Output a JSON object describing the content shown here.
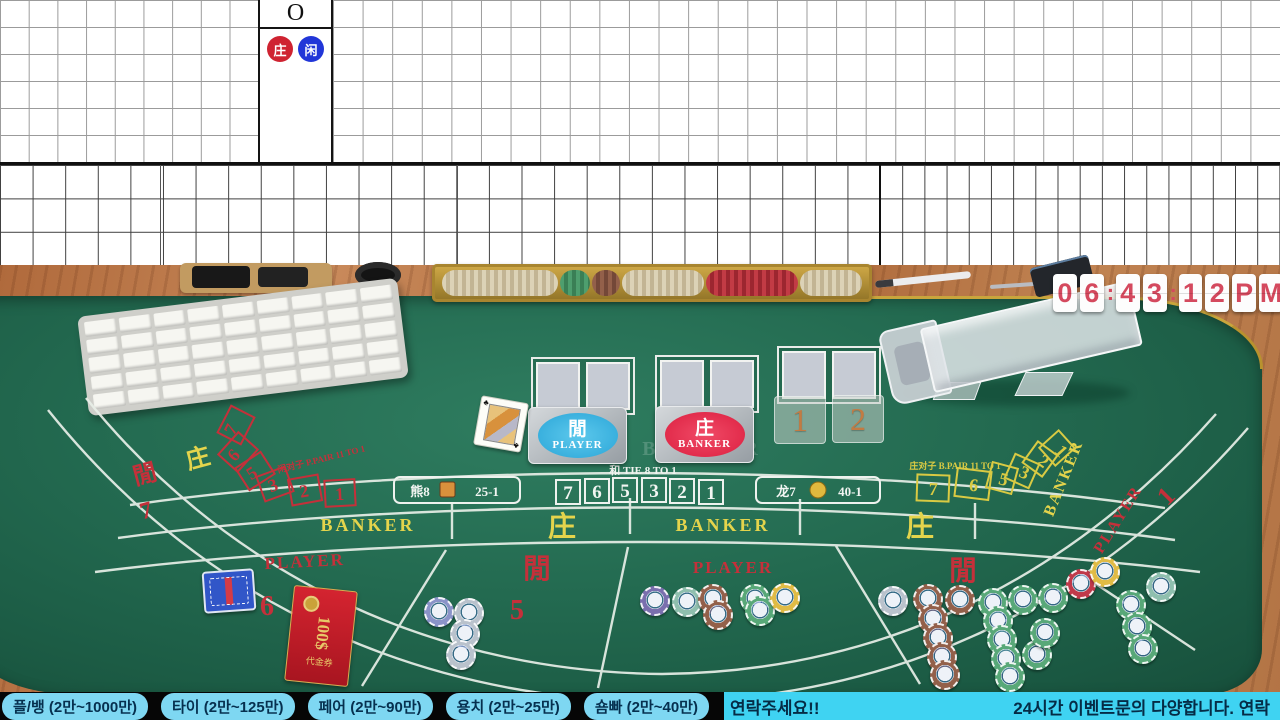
{
  "colors": {
    "felt_green": "#236a50",
    "banker_red": "#c5303a",
    "player_blue": "#2ba6d8",
    "gold": "#d9ca43",
    "pill_blue": "#7ed7f2",
    "marquee_cyan": "#3fd3f2",
    "clock_red": "#d4495e"
  },
  "scoreboard": {
    "header_marker": "O",
    "legend_banker": "庄",
    "legend_player": "闲"
  },
  "clock": {
    "cells": [
      "0",
      "6",
      ":",
      "4",
      "3",
      ":",
      "1",
      "2",
      "P",
      "M"
    ]
  },
  "table": {
    "tie_label": "和 TIE 8 TO 1",
    "panda": {
      "name": "熊8",
      "odds": "25-1"
    },
    "dragon": {
      "name": "龙7",
      "odds": "40-1"
    },
    "player_pair_label": "闲对子 P.PAIR 11 TO 1",
    "banker_pair_label": "庄对子 B.PAIR 11 TO 1",
    "center_numbers": [
      "7",
      "6",
      "5",
      "3",
      "2",
      "1"
    ],
    "left_arc_numbers": [
      "7",
      "6",
      "5",
      "3",
      "2",
      "1"
    ],
    "right_arc_numbers": [
      "7",
      "6",
      "5",
      "3",
      "2",
      "1"
    ],
    "banker_en": "BANKER",
    "player_en": "PLAYER",
    "banker_cn": "庄",
    "player_cn": "閒",
    "seat_left": "7",
    "seat_six": "6",
    "seat_five": "5",
    "seat_right": "1",
    "marker_one": "1",
    "marker_two": "2",
    "plaque_player": {
      "cn": "閒",
      "en": "PLAYER"
    },
    "plaque_banker": {
      "cn": "庄",
      "en": "BANKER"
    },
    "voucher": {
      "title": "代金券",
      "amount": "100$"
    }
  },
  "bottom_bar": {
    "limits": [
      "플/뱅 (2만~1000만)",
      "타이 (2만~125만)",
      "페어 (2만~90만)",
      "용치 (2만~25만)",
      "숌빠 (2만~40만)"
    ],
    "marquee_left": "연락주세요!!",
    "marquee_right": "24시간 이벤트문의 다양합니다. 연락"
  }
}
